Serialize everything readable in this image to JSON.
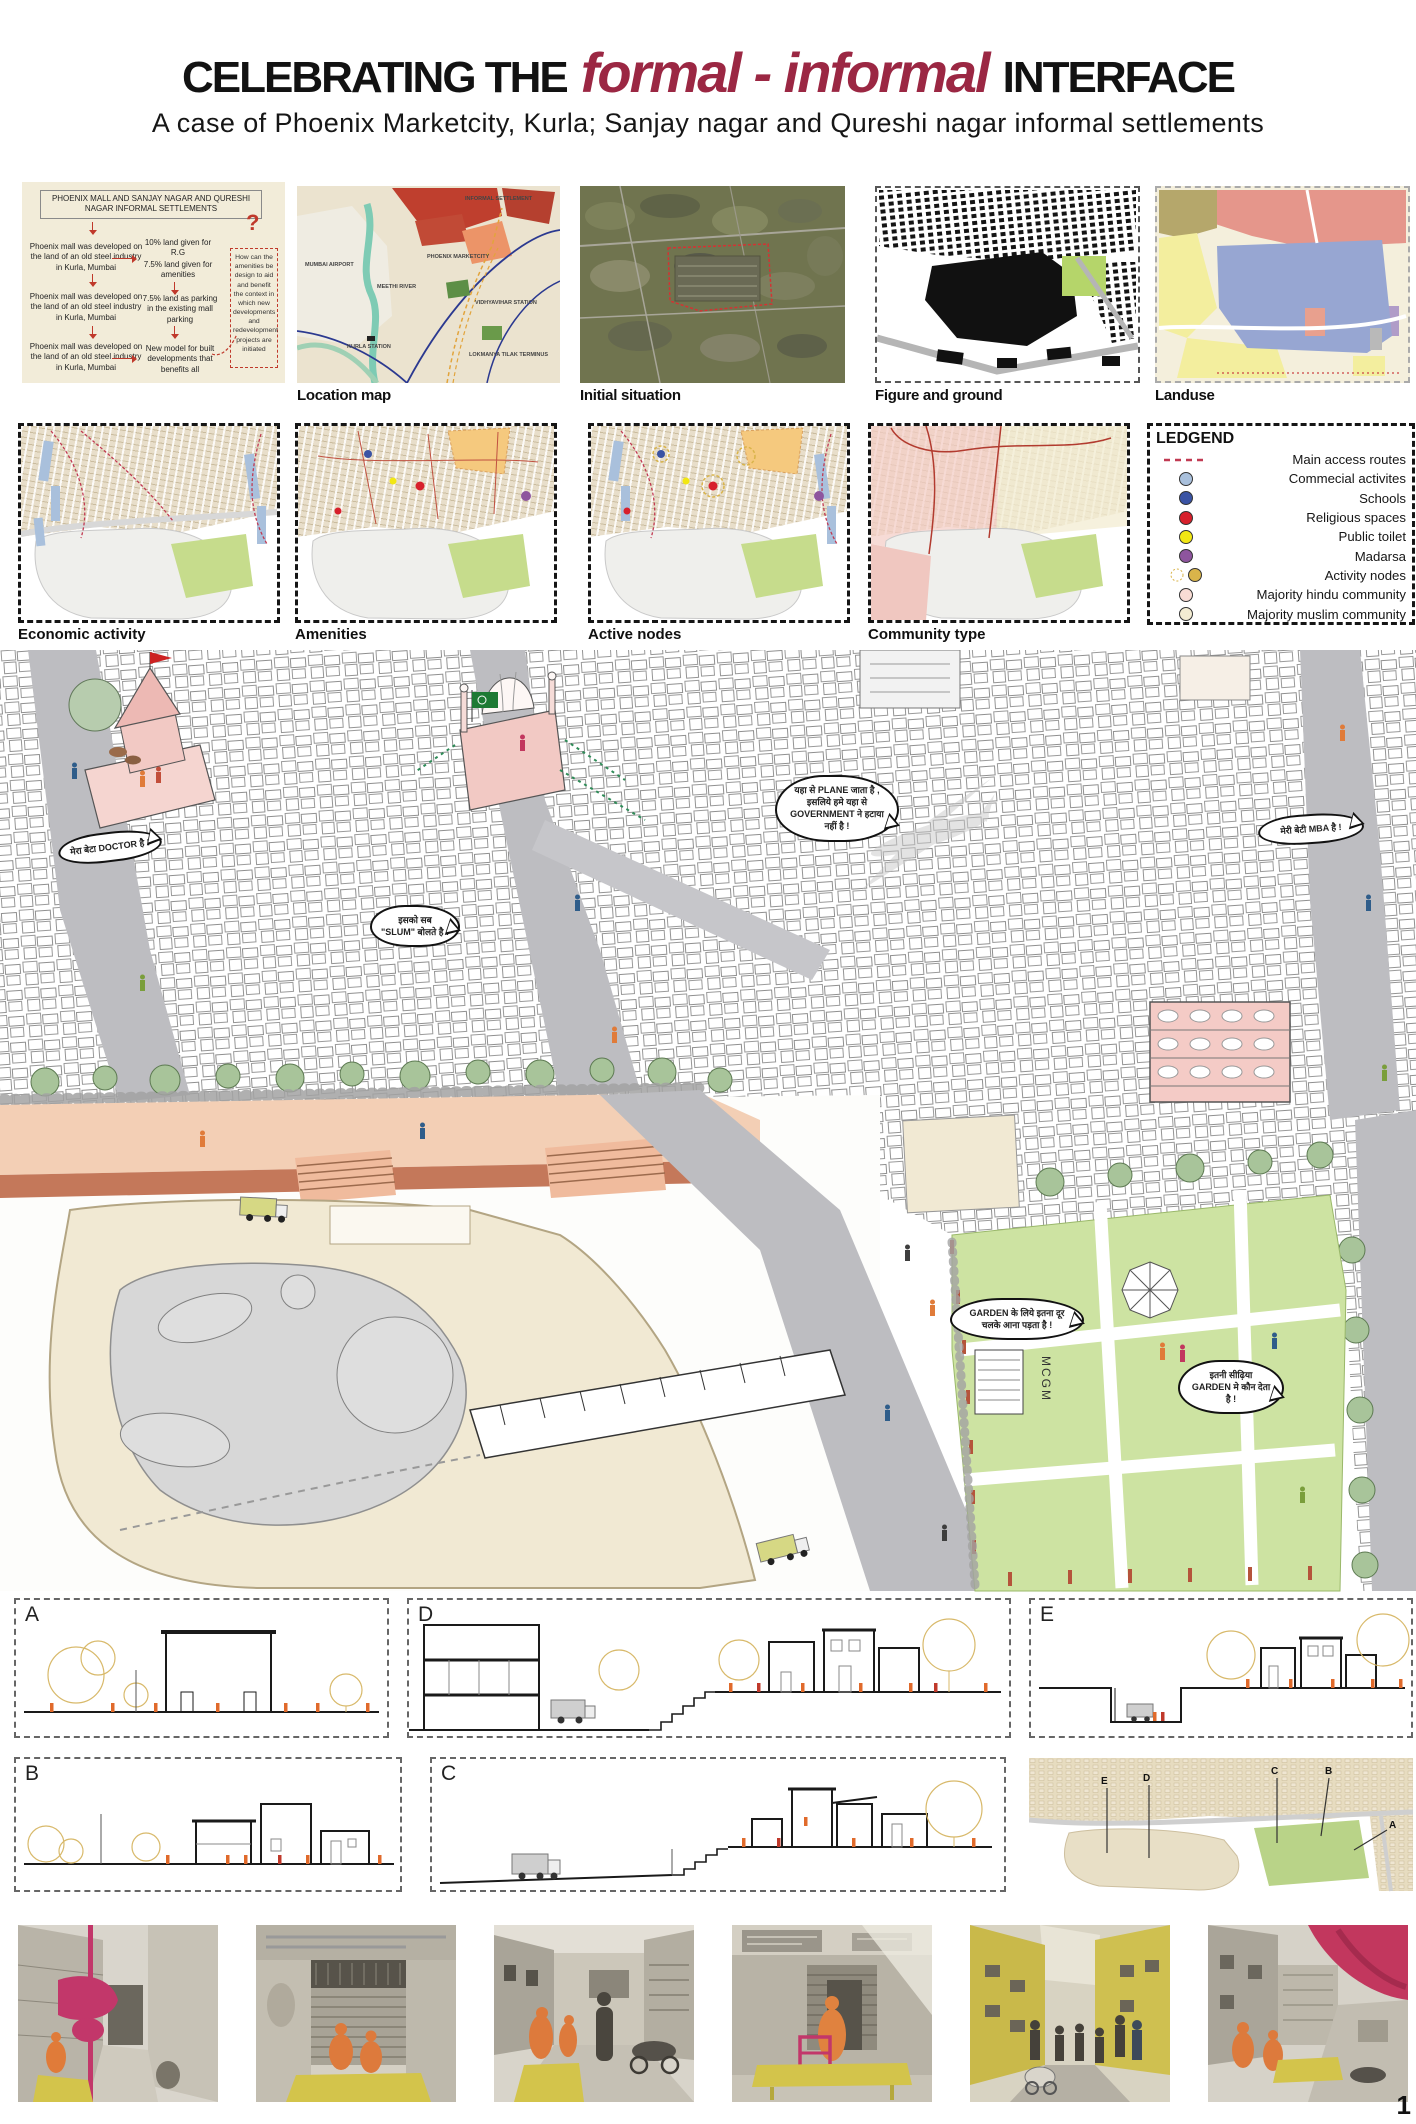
{
  "page_number": "1",
  "header": {
    "title_prefix": "CELEBRATING THE",
    "title_accent": "formal - informal",
    "title_suffix": "INTERFACE",
    "subtitle": "A case of Phoenix Marketcity, Kurla; Sanjay nagar and Qureshi nagar informal settlements",
    "accent_color": "#9b2743"
  },
  "flowchart": {
    "title": "PHOENIX MALL AND SANJAY NAGAR AND QURESHI NAGAR INFORMAL SETTLEMENTS",
    "left": [
      "Phoenix mall was developed on the land of an old steel industry in Kurla, Mumbai",
      "Phoenix mall was developed on the land of an old steel industry in Kurla, Mumbai",
      "Phoenix mall was developed on the land of an old steel industry in Kurla, Mumbai"
    ],
    "right": [
      "10% land given for R.G",
      "7.5% land given for amenities",
      "7.5% land as parking in the existing mall parking",
      "New model for built developments that benefits all"
    ],
    "question_mark": "?",
    "question": "How can the amenities be design to aid and benefit the context in which new developments and redevelopment projects are initiated"
  },
  "top_maps": {
    "location": {
      "caption": "Location map",
      "ann": {
        "airport": "MUMBAI AIRPORT",
        "river": "MEETHI RIVER",
        "informal": "INFORMAL SETTLEMENT",
        "phoenix": "PHOENIX MARKETCITY",
        "vidhyavihar": "VIDHYAVIHAR STATION",
        "kurla": "KURLA STATION",
        "lokmanya": "LOKMANYA TILAK TERMINUS"
      }
    },
    "initial": {
      "caption": "Initial situation"
    },
    "figure_ground": {
      "caption": "Figure and ground"
    },
    "landuse": {
      "caption": "Landuse"
    }
  },
  "analysis_maps": {
    "labels": [
      "Economic activity",
      "Amenities",
      "Active nodes",
      "Community type"
    ]
  },
  "legend": {
    "title": "LEDGEND",
    "items": [
      {
        "label": "Main access routes",
        "swatch": "dashed-line",
        "color": "#c13a52"
      },
      {
        "label": "Commecial activites",
        "swatch": "circle",
        "color": "#a9c0dc"
      },
      {
        "label": "Schools",
        "swatch": "circle",
        "color": "#3a53a4"
      },
      {
        "label": "Religious spaces",
        "swatch": "circle",
        "color": "#d7202c"
      },
      {
        "label": "Public toilet",
        "swatch": "circle",
        "color": "#f2e713"
      },
      {
        "label": "Madarsa",
        "swatch": "circle",
        "color": "#8e559e"
      },
      {
        "label": "Activity nodes",
        "swatch": "circle-with-dashed-ring",
        "color": "#d9b44a"
      },
      {
        "label": "Majority hindu community",
        "swatch": "circle",
        "color": "#f8dcd4"
      },
      {
        "label": "Majority muslim community",
        "swatch": "circle",
        "color": "#f3ecd2"
      }
    ]
  },
  "illustration": {
    "bubbles": [
      "मेरा बेटा DOCTOR है !",
      "इसको सब \"SLUM\" बोलते है !",
      "यहा से PLANE जाता है , इसलिये हमे यहा से GOVERNMENT ने हटाया नहीं है !",
      "मेरी बेटी MBA है !",
      "GARDEN के लिये इतना दूर चलके आना पड़ता है !",
      "इतनी सीढ़िया GARDEN मे कौन देता है !"
    ],
    "mcgm": "MCGM"
  },
  "sections": {
    "a": "A",
    "b": "B",
    "c": "C",
    "d": "D",
    "e": "E"
  },
  "keyplan": {
    "markers": [
      "E",
      "D",
      "C",
      "B",
      "A"
    ]
  },
  "photos": [
    "informal-alley",
    "shop-shutter",
    "street-figures",
    "shop-entrance",
    "yellow-street",
    "canopy-street"
  ]
}
